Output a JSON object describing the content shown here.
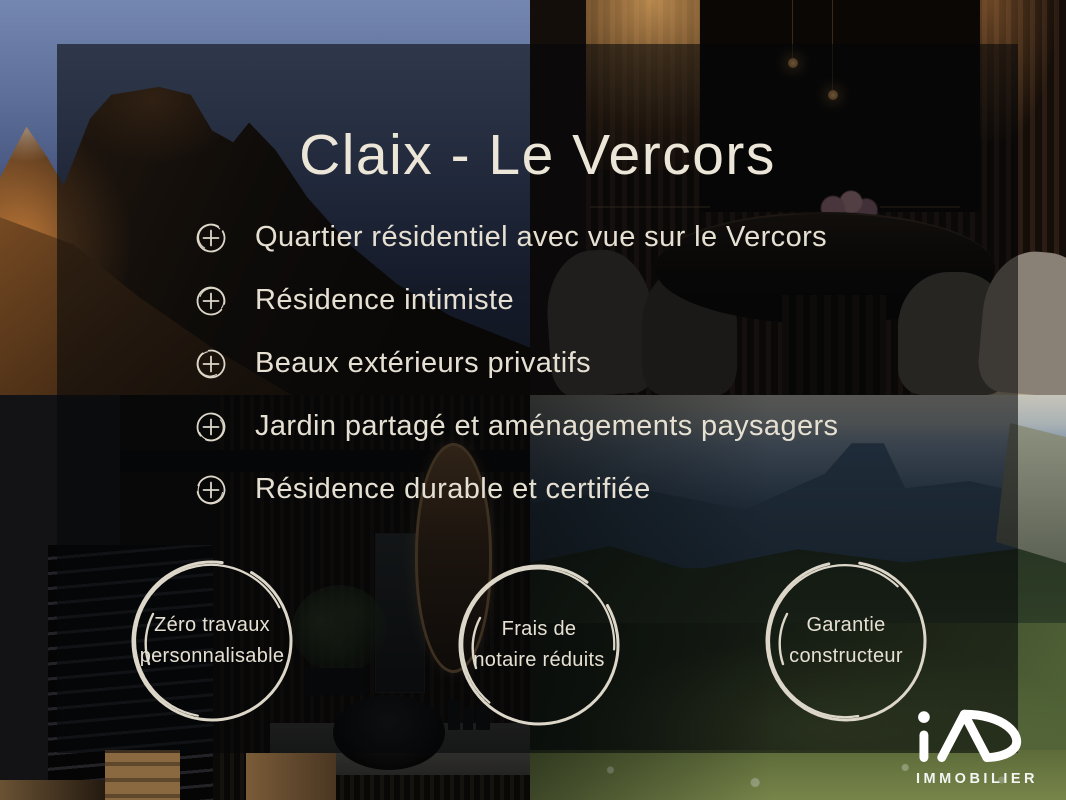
{
  "title": "Claix - Le Vercors",
  "features": [
    "Quartier résidentiel avec vue sur le Vercors",
    "Résidence intimiste",
    "Beaux extérieurs privatifs",
    "Jardin partagé et aménagements paysagers",
    "Résidence durable et certifiée"
  ],
  "badges": [
    {
      "line1": "Zéro travaux",
      "line2": "personnalisable"
    },
    {
      "line1": "Frais de",
      "line2": "notaire réduits"
    },
    {
      "line1": "Garantie",
      "line2": "constructeur"
    }
  ],
  "logo": {
    "brand": "iAD",
    "subtitle": "IMMOBILIER"
  },
  "style": {
    "text_color": "#e7e1d3",
    "overlay_color": "rgba(6,7,9,0.58)",
    "logo_color": "#ffffff"
  }
}
